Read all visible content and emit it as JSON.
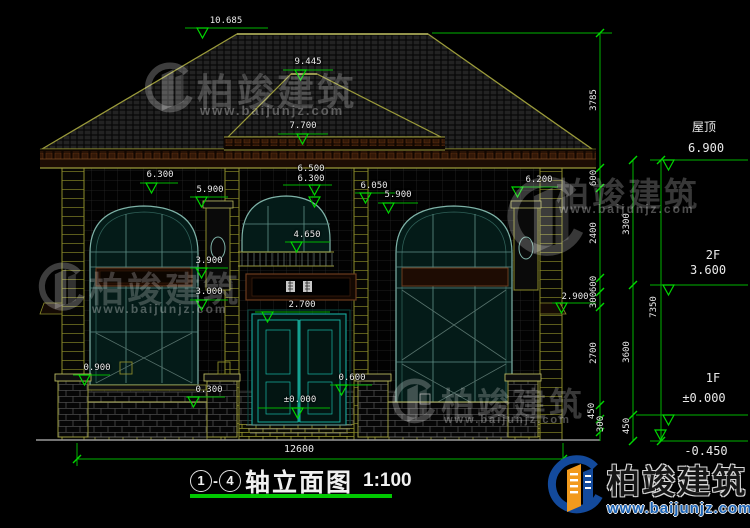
{
  "drawing": {
    "title": {
      "axis_start": "1",
      "separator": "-",
      "axis_end": "4",
      "label": "轴立面图",
      "scale": "1:100"
    },
    "annotations": {
      "d10685": "10.685",
      "d9445": "9.445",
      "d7700": "7.700",
      "d6500c": "6.500",
      "d6300c": "6.300",
      "d6300l": "6.300",
      "d5900l": "5.900",
      "d6050": "6.050",
      "d5900c": "5.900",
      "d6200": "6.200",
      "d4650": "4.650",
      "d3900": "3.900",
      "d3000": "3.000",
      "d2900": "2.900",
      "d2700": "2.700",
      "d0900": "0.900",
      "d0300": "0.300",
      "d0600": "0.600",
      "d0000c": "±0.000",
      "roof_label": "屋顶",
      "d6900r": "6.900",
      "f2": "2F",
      "d3600r": "3.600",
      "f1": "1F",
      "d0000r": "±0.000",
      "dm0450": "-0.450",
      "d12600": "12600"
    },
    "chain_dims": {
      "c3785": "3785",
      "c600a": "600",
      "c2400": "2400",
      "c600b": "600",
      "c300a": "300",
      "c2700": "2700",
      "c450a": "450",
      "c300b": "300",
      "c3300": "3300",
      "c3600": "3600",
      "c450b": "450",
      "c7350": "7350"
    }
  },
  "watermark": {
    "brand": "柏竣建筑",
    "url": "www.baijunjz.com"
  },
  "logo": {
    "brand": "柏竣建筑",
    "url": "www.baijunjz.com"
  },
  "colors": {
    "line_green": "#00b400",
    "marker_green": "#00d800",
    "cad_yellow": "#9a9a3a",
    "window_teal": "#7fb3a8",
    "door_cyan": "#19b8a8",
    "logo_blue": "#1b63b5",
    "logo_orange": "#f29a1d"
  }
}
